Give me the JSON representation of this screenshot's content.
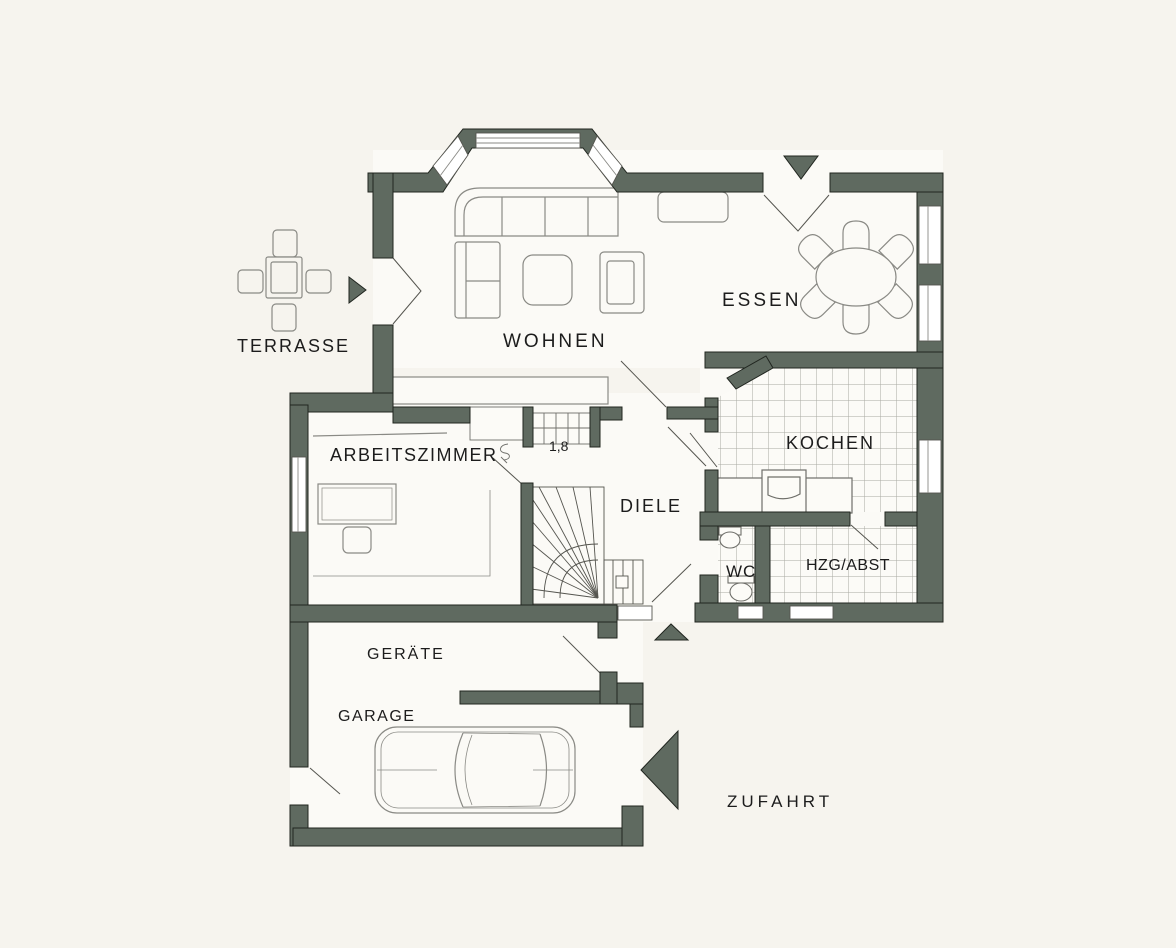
{
  "title": "Erdgeschoss Grundriss",
  "colors": {
    "background": "#f6f4ee",
    "floor": "#fbfaf6",
    "wall": "#5f6a60",
    "wall_outline": "#20251f",
    "furniture_line": "#8a8a85",
    "tile_line": "#a9a9a2",
    "text": "#1c1c1c"
  },
  "rooms": [
    {
      "id": "terrasse",
      "label": "TERRASSE"
    },
    {
      "id": "wohnen",
      "label": "WOHNEN"
    },
    {
      "id": "essen",
      "label": "ESSEN"
    },
    {
      "id": "arbeitszimmer",
      "label": "ARBEITSZIMMER"
    },
    {
      "id": "diele",
      "label": "DIELE"
    },
    {
      "id": "kochen",
      "label": "KOCHEN"
    },
    {
      "id": "wc",
      "label": "WC"
    },
    {
      "id": "hzg_abst",
      "label": "HZG/ABST"
    },
    {
      "id": "geraete",
      "label": "GERÄTE"
    },
    {
      "id": "garage",
      "label": "GARAGE"
    },
    {
      "id": "zufahrt",
      "label": "ZUFAHRT"
    }
  ],
  "annotations": {
    "stair_niche_measure": "1,8"
  },
  "arrows": [
    {
      "id": "terrace-entry-arrow",
      "direction": "right"
    },
    {
      "id": "garden-entry-arrow",
      "direction": "down"
    },
    {
      "id": "main-entry-arrow",
      "direction": "up"
    },
    {
      "id": "garage-entry-arrow",
      "direction": "left"
    }
  ]
}
